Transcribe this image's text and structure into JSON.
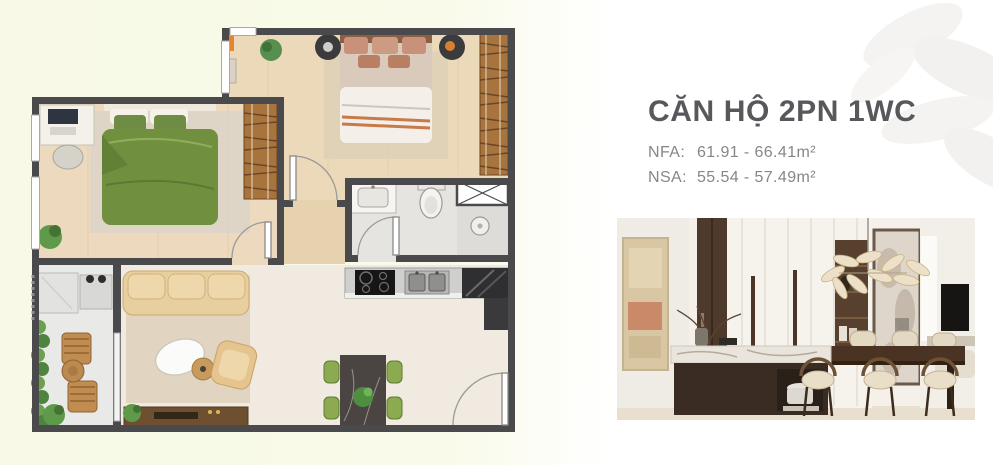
{
  "unit_card": {
    "title": "CĂN HỘ 2PN 1WC",
    "specs": [
      {
        "label": "NFA:",
        "value": "61.91 - 66.41m²"
      },
      {
        "label": "NSA:",
        "value": "55.54 - 57.49m²"
      }
    ]
  },
  "palette": {
    "background_left_tint": "#f8fae7",
    "background_right": "#ffffff",
    "title_color": "#57585b",
    "spec_text_color": "#85868a",
    "plan_wall_color": "#4a4a4c",
    "plan_wood_floor": "#ecd9ba",
    "plan_cream_floor": "#f0eae1",
    "plan_bed_green": "#71903f",
    "plan_wardrobe_wood": "#a8743e",
    "plan_sofa_beige": "#e8cfa0",
    "plan_dining_chair_green": "#8cab51",
    "watermark_leaf": "#eceae6"
  },
  "icons": {
    "floor_plan": "apartment-floor-plan-top-view",
    "interior_photo": "kitchen-dining-interior-render",
    "watermark": "leaf-watermark"
  }
}
